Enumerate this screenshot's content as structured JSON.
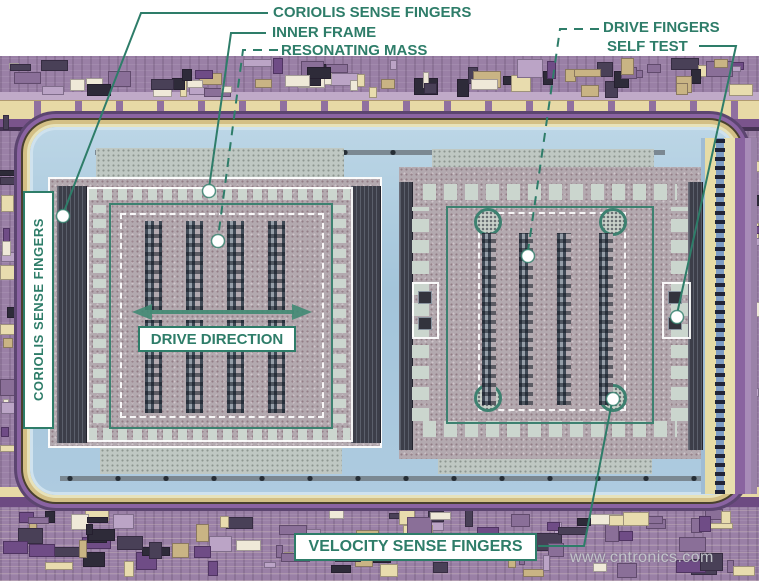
{
  "labels": {
    "coriolis_top": "CORIOLIS SENSE FINGERS",
    "inner_frame": "INNER FRAME",
    "resonating_mass": "RESONATING MASS",
    "drive_fingers": "DRIVE FINGERS",
    "self_test": "SELF TEST",
    "coriolis_side": "CORIOLIS SENSE FINGERS",
    "drive_direction": "DRIVE DIRECTION",
    "velocity_sense": "VELOCITY SENSE FINGERS"
  },
  "watermark": "www.cntronics.com",
  "colors": {
    "annotation_teal": "#2e7d69",
    "label_bg": "#ffffff",
    "die_purple": "#9a80a6",
    "cavity_blue": "#a9cade",
    "gold_band": "#e7d9a6",
    "structure_gray": "#b3a9af",
    "finger_dark": "#3c3e49",
    "watermark_gray": "#c6c8cd"
  }
}
